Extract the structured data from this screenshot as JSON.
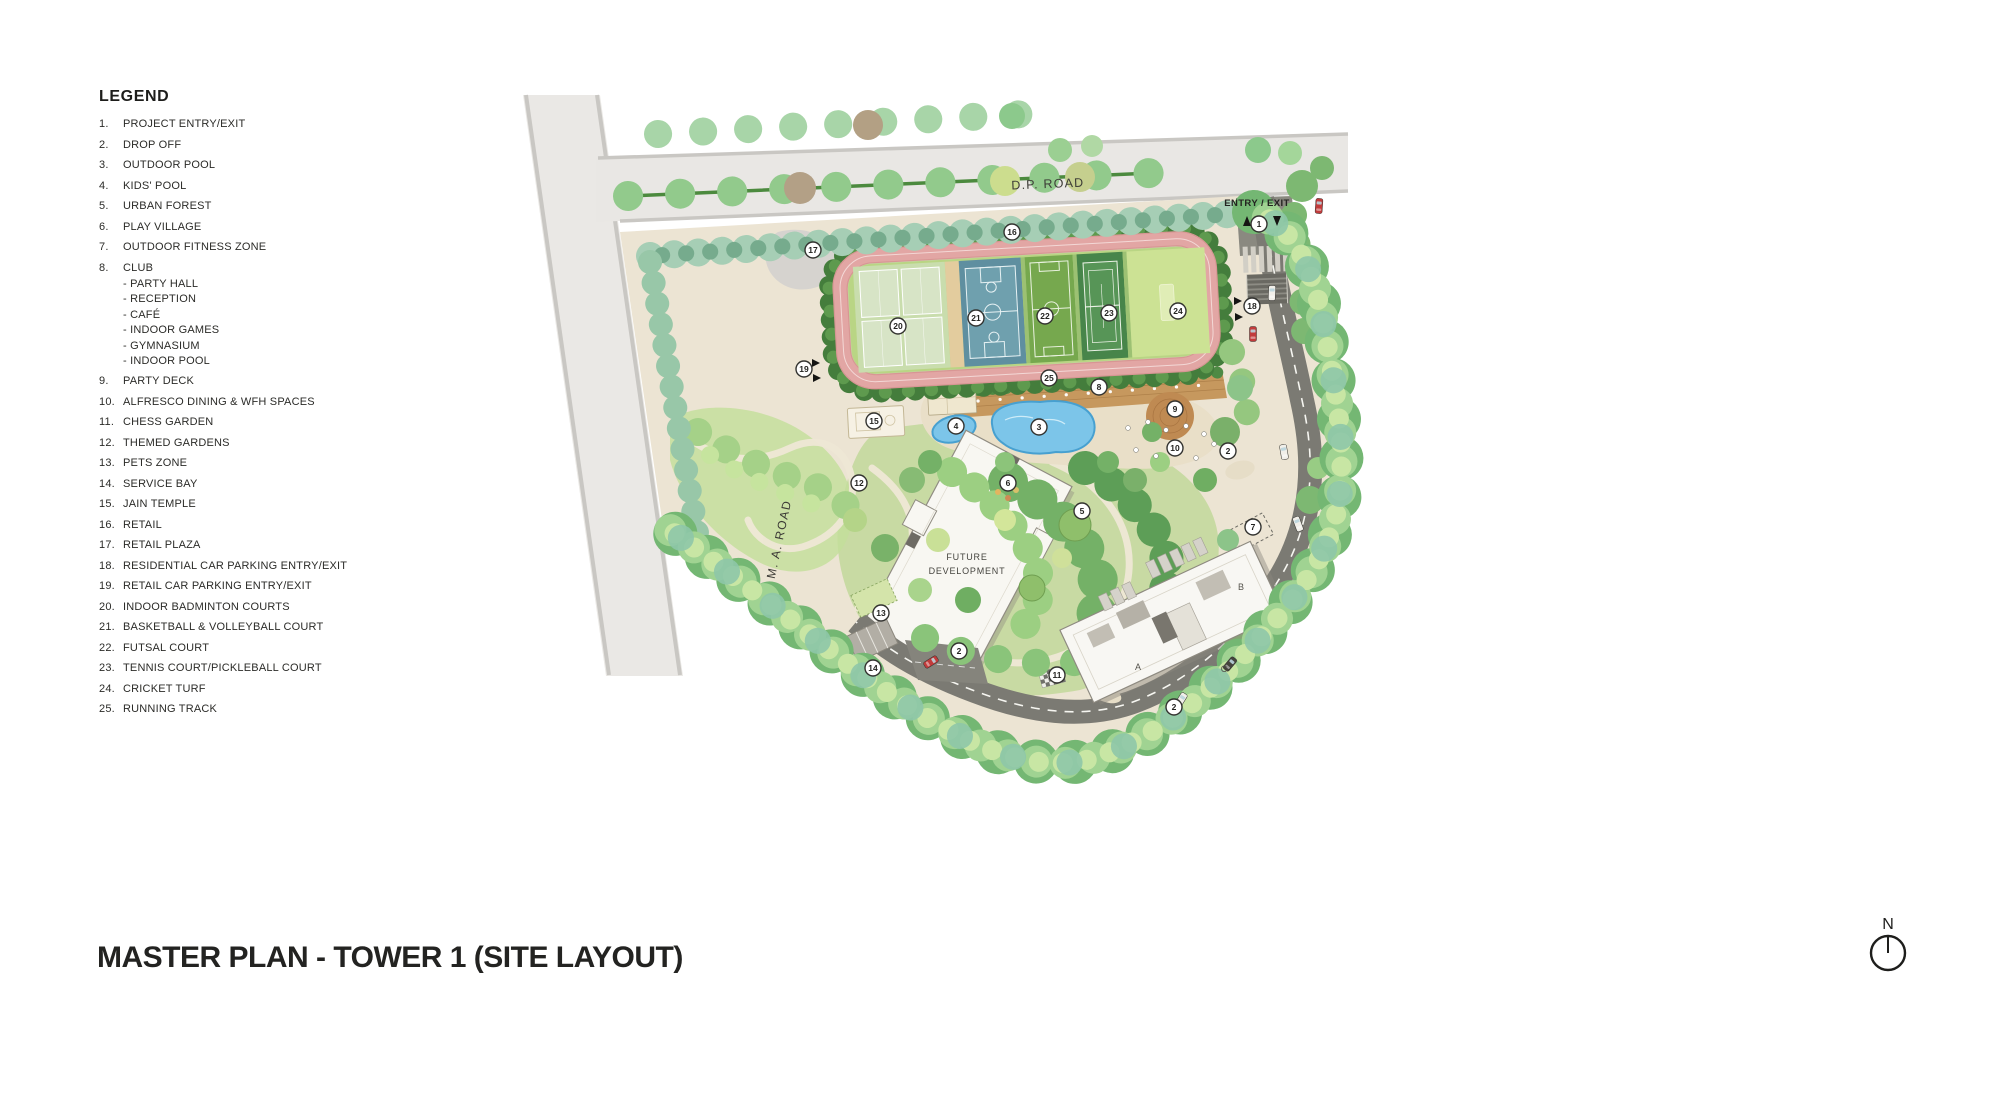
{
  "title": "MASTER PLAN - TOWER 1 (SITE LAYOUT)",
  "legend": {
    "title": "LEGEND",
    "items": [
      {
        "num": "1.",
        "label": "PROJECT ENTRY/EXIT"
      },
      {
        "num": "2.",
        "label": "DROP OFF"
      },
      {
        "num": "3.",
        "label": "OUTDOOR POOL"
      },
      {
        "num": "4.",
        "label": "KIDS' POOL"
      },
      {
        "num": "5.",
        "label": "URBAN FOREST"
      },
      {
        "num": "6.",
        "label": "PLAY VILLAGE"
      },
      {
        "num": "7.",
        "label": "OUTDOOR FITNESS ZONE"
      },
      {
        "num": "8.",
        "label": "CLUB",
        "sub": [
          "- PARTY HALL",
          "- RECEPTION",
          "- CAFÉ",
          "- INDOOR GAMES",
          "- GYMNASIUM",
          "- INDOOR POOL"
        ]
      },
      {
        "num": "9.",
        "label": "PARTY DECK"
      },
      {
        "num": "10.",
        "label": "ALFRESCO DINING & WFH SPACES"
      },
      {
        "num": "11.",
        "label": "CHESS GARDEN"
      },
      {
        "num": "12.",
        "label": "THEMED GARDENS"
      },
      {
        "num": "13.",
        "label": "PETS ZONE"
      },
      {
        "num": "14.",
        "label": "SERVICE BAY"
      },
      {
        "num": "15.",
        "label": "JAIN TEMPLE"
      },
      {
        "num": "16.",
        "label": "RETAIL"
      },
      {
        "num": "17.",
        "label": "RETAIL PLAZA"
      },
      {
        "num": "18.",
        "label": "RESIDENTIAL CAR PARKING ENTRY/EXIT"
      },
      {
        "num": "19.",
        "label": "RETAIL CAR PARKING ENTRY/EXIT"
      },
      {
        "num": "20.",
        "label": "INDOOR BADMINTON COURTS"
      },
      {
        "num": "21.",
        "label": "BASKETBALL & VOLLEYBALL COURT"
      },
      {
        "num": "22.",
        "label": "FUTSAL COURT"
      },
      {
        "num": "23.",
        "label": "TENNIS COURT/PICKLEBALL COURT"
      },
      {
        "num": "24.",
        "label": "CRICKET TURF"
      },
      {
        "num": "25.",
        "label": "RUNNING TRACK"
      }
    ]
  },
  "plan": {
    "labels": {
      "dp_road": "D.P. ROAD",
      "ma_road": "M. A. ROAD",
      "entry_exit": "ENTRY / EXIT",
      "future_dev_line1": "FUTURE",
      "future_dev_line2": "DEVELOPMENT",
      "north": "N",
      "wing_a": "A",
      "wing_b": "B",
      "wing_c": "C"
    },
    "markers": [
      {
        "n": "1",
        "x": 1259,
        "y": 224
      },
      {
        "n": "2",
        "x": 1228,
        "y": 451
      },
      {
        "n": "2",
        "x": 959,
        "y": 651
      },
      {
        "n": "2",
        "x": 1174,
        "y": 707
      },
      {
        "n": "3",
        "x": 1039,
        "y": 427
      },
      {
        "n": "4",
        "x": 956,
        "y": 426
      },
      {
        "n": "5",
        "x": 1082,
        "y": 511
      },
      {
        "n": "6",
        "x": 1008,
        "y": 483
      },
      {
        "n": "7",
        "x": 1253,
        "y": 527
      },
      {
        "n": "8",
        "x": 1099,
        "y": 387
      },
      {
        "n": "9",
        "x": 1175,
        "y": 409
      },
      {
        "n": "10",
        "x": 1175,
        "y": 448
      },
      {
        "n": "11",
        "x": 1057,
        "y": 675
      },
      {
        "n": "12",
        "x": 859,
        "y": 483
      },
      {
        "n": "13",
        "x": 881,
        "y": 613
      },
      {
        "n": "14",
        "x": 873,
        "y": 668
      },
      {
        "n": "15",
        "x": 874,
        "y": 421
      },
      {
        "n": "16",
        "x": 1012,
        "y": 232
      },
      {
        "n": "17",
        "x": 813,
        "y": 250
      },
      {
        "n": "18",
        "x": 1252,
        "y": 306
      },
      {
        "n": "19",
        "x": 804,
        "y": 369
      },
      {
        "n": "20",
        "x": 898,
        "y": 326
      },
      {
        "n": "21",
        "x": 976,
        "y": 318
      },
      {
        "n": "22",
        "x": 1045,
        "y": 316
      },
      {
        "n": "23",
        "x": 1109,
        "y": 313
      },
      {
        "n": "24",
        "x": 1178,
        "y": 311
      },
      {
        "n": "25",
        "x": 1049,
        "y": 378
      }
    ],
    "colors": {
      "site_beige": "#ece4d3",
      "road_gray": "#e9e7e4",
      "asphalt": "#7b7a73",
      "track_pink": "#e2a6a4",
      "infield_green": "#b9d584",
      "basketball_blue": "#6fa0ae",
      "futsal_green": "#76a84e",
      "tennis_green": "#47854a",
      "cricket_green": "#cce294",
      "pool_blue": "#7cc5e9",
      "deck_wood": "#c6985e",
      "tree_green": "#74b773",
      "hedge_dark": "#447d3c"
    }
  }
}
